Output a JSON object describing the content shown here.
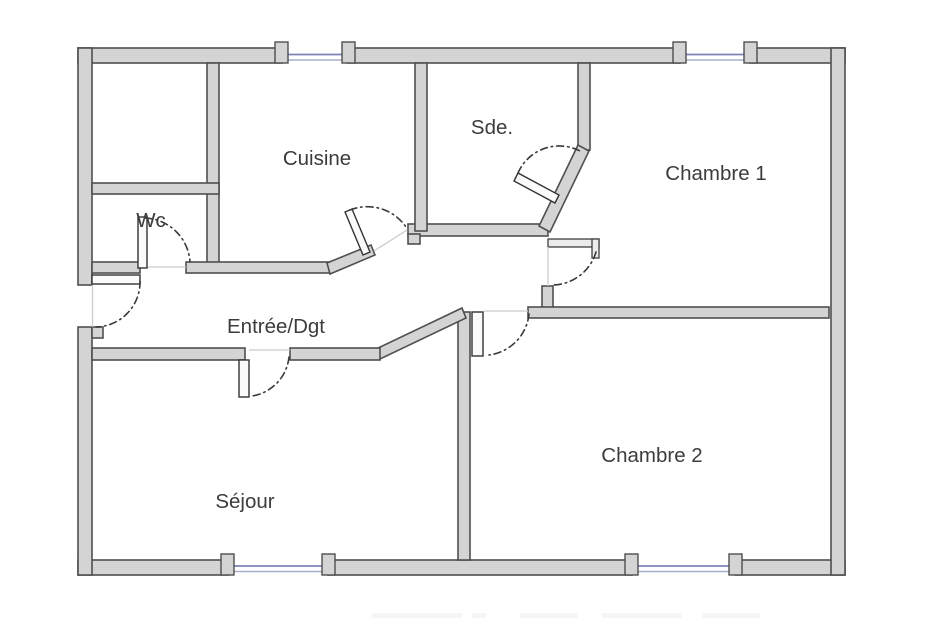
{
  "plan": {
    "type": "apartment-floor-plan",
    "rooms": [
      {
        "id": "wc",
        "label": "Wc"
      },
      {
        "id": "cuisine",
        "label": "Cuisine"
      },
      {
        "id": "sde",
        "label": "Sde."
      },
      {
        "id": "chambre1",
        "label": "Chambre 1"
      },
      {
        "id": "entree",
        "label": "Entrée/Dgt"
      },
      {
        "id": "sejour",
        "label": "Séjour"
      },
      {
        "id": "chambre2",
        "label": "Chambre 2"
      }
    ],
    "windows": [
      "top-cuisine-window",
      "top-chambre1-window",
      "bottom-sejour-window",
      "bottom-chambre2-window"
    ],
    "doors": [
      "entrance-door",
      "wc-door",
      "cuisine-door",
      "sde-door",
      "chambre1-door",
      "chambre2-door",
      "sejour-door"
    ],
    "colors": {
      "wall_fill": "#d4d4d4",
      "wall_stroke": "#4f4f4f",
      "window_frame": "#7d82b8",
      "door_swing": "#3a3a3a",
      "label_text": "#3c3c3c",
      "background": "#ffffff"
    }
  }
}
